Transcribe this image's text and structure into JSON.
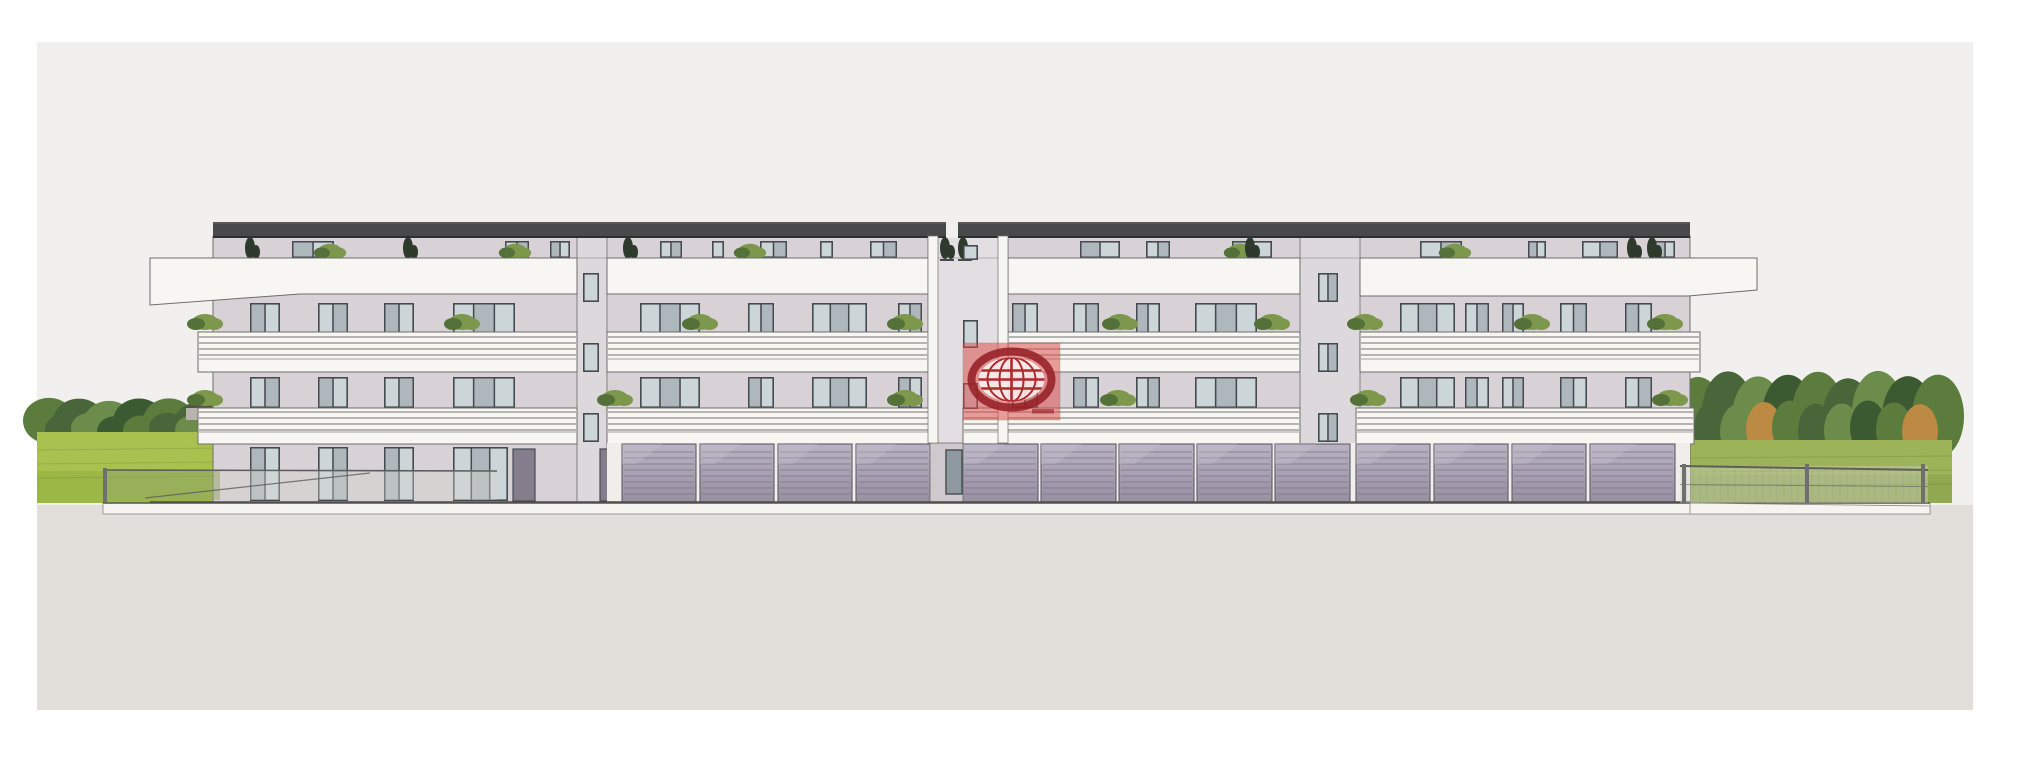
{
  "meta": {
    "kind": "architectural-front-elevation-rendering",
    "subject": "Four-storey apartment building with roof terrace, balconies and ground-floor garages",
    "icons": {
      "watermark": "globe-icon"
    }
  },
  "canvas": {
    "width": 2021,
    "height": 768
  },
  "palette": {
    "margin": "#ffffff",
    "sky": "#f1f0ee",
    "groundPlane": "#e2ded9",
    "roof": "#47494b",
    "roofEdge": "#2d2e30",
    "wall": "#d8d1d5",
    "strip": "#ddd8db",
    "tower": "#e3dee1",
    "passage": "#cfc9cd",
    "white": "#f7f6f3",
    "bandLine": "#8f8d8a",
    "outline": "#6f6d6a",
    "winFrame": "#454a50",
    "glass": "#ccd6d9",
    "glassDark": "#8f9aa0",
    "doorDark": "#847e8c",
    "garageHi": "#b9b3c2",
    "garageLo": "#978fa2",
    "garageLine": "#7e7789",
    "pillarBg": "#efeeeb",
    "plinth": "#f5f4f1",
    "bush": "#7d984c",
    "bushDark": "#55713a",
    "cypress": "#2e3a2b",
    "grassL1": "#a9c24f",
    "grassL2": "#8fb03c",
    "grassR1": "#9cb357",
    "grassR2": "#87a14a",
    "tree1": "#5c7c3e",
    "tree2": "#48663a",
    "tree3": "#6b8c4a",
    "treeDark": "#3c5a31",
    "treeOrange": "#bd8a43",
    "houseWall": "#b8b3ac",
    "houseRoof": "#575049",
    "fenceMesh": "rgba(210,214,206,0.38)",
    "fenceGreen": "rgba(150,170,108,0.55)",
    "fencePost": "#6f6f6d",
    "fenceRail": "#5d5d5b",
    "logoRed": "#dd4a4a",
    "logoRing": "#931d22",
    "logoGrid": "#b02a2c",
    "logoWhite": "rgba(255,255,255,0.78)"
  },
  "frame": {
    "x": 37,
    "y": 42,
    "w": 1936,
    "h": 668,
    "groundY": 505
  },
  "landscape": {
    "left": {
      "trees": {
        "x0": 37,
        "x1": 222,
        "yTop": 398,
        "yBottom": 442
      },
      "grass": {
        "x0": 37,
        "x1": 220,
        "yTop": 432,
        "yBottom": 503
      },
      "house": {
        "x": 186,
        "y": 402,
        "w": 26,
        "h": 18
      }
    },
    "right": {
      "trees": {
        "x0": 1686,
        "x1": 1952,
        "yTop": 372,
        "yBottom": 452,
        "autumn": true
      },
      "grass": {
        "x0": 1686,
        "x1": 1952,
        "yTop": 440,
        "yBottom": 503
      }
    }
  },
  "building": {
    "wall": {
      "x": 213,
      "right": 1690,
      "top": 236,
      "bottom": 502
    },
    "roof": {
      "x": 213,
      "w": 1477,
      "y": 222,
      "h": 15,
      "gapX": 946,
      "gapW": 12
    },
    "stairStrips": [
      {
        "x": 577,
        "w": 30
      },
      {
        "x": 1300,
        "w": 60
      }
    ],
    "tower": {
      "x": 928,
      "w": 80,
      "pilasterW": 10,
      "bottom": 443
    },
    "fasciaSegs": [
      {
        "pts": "150,258 577,258 577,294 300,294 150,305"
      },
      {
        "pts": "607,258 928,258 928,294 607,294"
      },
      {
        "pts": "1008,258 1300,258 1300,294 1008,294"
      },
      {
        "pts": "1360,258 1757,258 1757,290 1688,296 1360,296"
      }
    ],
    "band1": {
      "y": 332,
      "h": 40,
      "railStart": 5,
      "railGap": 6,
      "rails": 4,
      "slabTop": 27,
      "segs": [
        [
          198,
          577
        ],
        [
          607,
          928
        ],
        [
          1008,
          1300
        ],
        [
          1360,
          1700
        ]
      ]
    },
    "band2": {
      "y": 408,
      "h": 36,
      "railStart": 4,
      "railGap": 6,
      "rails": 4,
      "slabTop": 24,
      "segs": [
        [
          198,
          577
        ],
        [
          607,
          930
        ],
        [
          963,
          1300
        ],
        [
          1356,
          1694
        ]
      ]
    },
    "plinth": {
      "x": 103,
      "right": 1930,
      "y": 503,
      "h": 11,
      "rightWedge": "1690,503 1930,506 1930,514 1690,514"
    }
  },
  "windows": {
    "attic": {
      "y": 241,
      "h": 17,
      "xs": [
        [
          292,
          42
        ],
        [
          505,
          24
        ],
        [
          550,
          20
        ],
        [
          660,
          22
        ],
        [
          712,
          12
        ],
        [
          760,
          27
        ],
        [
          820,
          13
        ],
        [
          870,
          27
        ],
        [
          1080,
          40
        ],
        [
          1146,
          24
        ],
        [
          1232,
          40
        ],
        [
          1420,
          42
        ],
        [
          1528,
          18
        ],
        [
          1582,
          36
        ],
        [
          1655,
          20
        ]
      ]
    },
    "f3": {
      "y": 303,
      "h": 31,
      "xs": [
        [
          250,
          30
        ],
        [
          318,
          30
        ],
        [
          384,
          30
        ],
        [
          453,
          62
        ],
        [
          640,
          60
        ],
        [
          748,
          26
        ],
        [
          812,
          55
        ],
        [
          898,
          24
        ],
        [
          1012,
          26
        ],
        [
          1073,
          26
        ],
        [
          1136,
          24
        ],
        [
          1195,
          62
        ],
        [
          1400,
          55
        ],
        [
          1465,
          24
        ],
        [
          1502,
          22
        ],
        [
          1560,
          27
        ],
        [
          1625,
          27
        ]
      ]
    },
    "f2": {
      "y": 377,
      "h": 31,
      "xs": [
        [
          250,
          30
        ],
        [
          318,
          30
        ],
        [
          384,
          30
        ],
        [
          453,
          62
        ],
        [
          640,
          60
        ],
        [
          748,
          26
        ],
        [
          812,
          55
        ],
        [
          898,
          24
        ],
        [
          1012,
          26
        ],
        [
          1073,
          26
        ],
        [
          1136,
          24
        ],
        [
          1195,
          62
        ],
        [
          1400,
          55
        ],
        [
          1465,
          24
        ],
        [
          1502,
          22
        ],
        [
          1560,
          27
        ],
        [
          1625,
          27
        ]
      ]
    },
    "groundDoors": {
      "y": 447,
      "h": 54,
      "xs": [
        [
          250,
          30
        ],
        [
          318,
          30
        ],
        [
          384,
          30
        ],
        [
          453,
          55
        ]
      ]
    },
    "darkDoors": {
      "y": 449,
      "h": 52,
      "xs": [
        [
          513,
          22
        ],
        [
          600,
          20
        ]
      ]
    },
    "stair": {
      "ys": [
        273,
        343,
        413
      ],
      "h": 29,
      "xs": [
        [
          583,
          16
        ],
        [
          1318,
          20
        ]
      ]
    },
    "towerWins": {
      "x": 963,
      "w": 15,
      "items": [
        [
          245,
          15
        ],
        [
          320,
          28
        ],
        [
          383,
          26
        ]
      ]
    },
    "entryLight": {
      "x": 946,
      "y": 450,
      "w": 16,
      "h": 44
    }
  },
  "garages": {
    "zoneX": 607,
    "zoneRight": 1690,
    "y": 444,
    "h": 58,
    "passage": {
      "x": 930,
      "w": 33
    },
    "doors": [
      [
        622,
        74
      ],
      [
        700,
        74
      ],
      [
        778,
        74
      ],
      [
        856,
        74
      ],
      [
        963,
        75
      ],
      [
        1041,
        75
      ],
      [
        1119,
        75
      ],
      [
        1197,
        75
      ],
      [
        1275,
        75
      ],
      [
        1356,
        74
      ],
      [
        1434,
        74
      ],
      [
        1512,
        74
      ],
      [
        1590,
        85
      ]
    ]
  },
  "plants": {
    "bushesBand1": {
      "y": 322,
      "xs": [
        205,
        462,
        700,
        905,
        1120,
        1272,
        1365,
        1532,
        1665
      ]
    },
    "bushesBand2": {
      "y": 398,
      "xs": [
        205,
        615,
        905,
        1118,
        1368,
        1670
      ]
    },
    "atticBushes": {
      "y": 251,
      "xs": [
        330,
        515,
        750,
        1240,
        1455
      ]
    },
    "cypresses": {
      "y": 240,
      "xs": [
        250,
        408,
        628,
        945,
        963,
        1250,
        1632,
        1652
      ]
    }
  },
  "fences": {
    "left": {
      "x0": 105,
      "xSplit": 220,
      "x1": 497,
      "yTop": 470,
      "yBottom": 500,
      "diag": [
        145,
        498,
        370,
        473
      ]
    },
    "right": {
      "x0": 1680,
      "x1": 1928,
      "yTop": 466,
      "yTopEnd": 470,
      "yBottom": 503,
      "posts": [
        1682,
        1805,
        1921
      ]
    }
  },
  "logo": {
    "x": 963,
    "y": 343,
    "w": 97,
    "h": 77
  }
}
